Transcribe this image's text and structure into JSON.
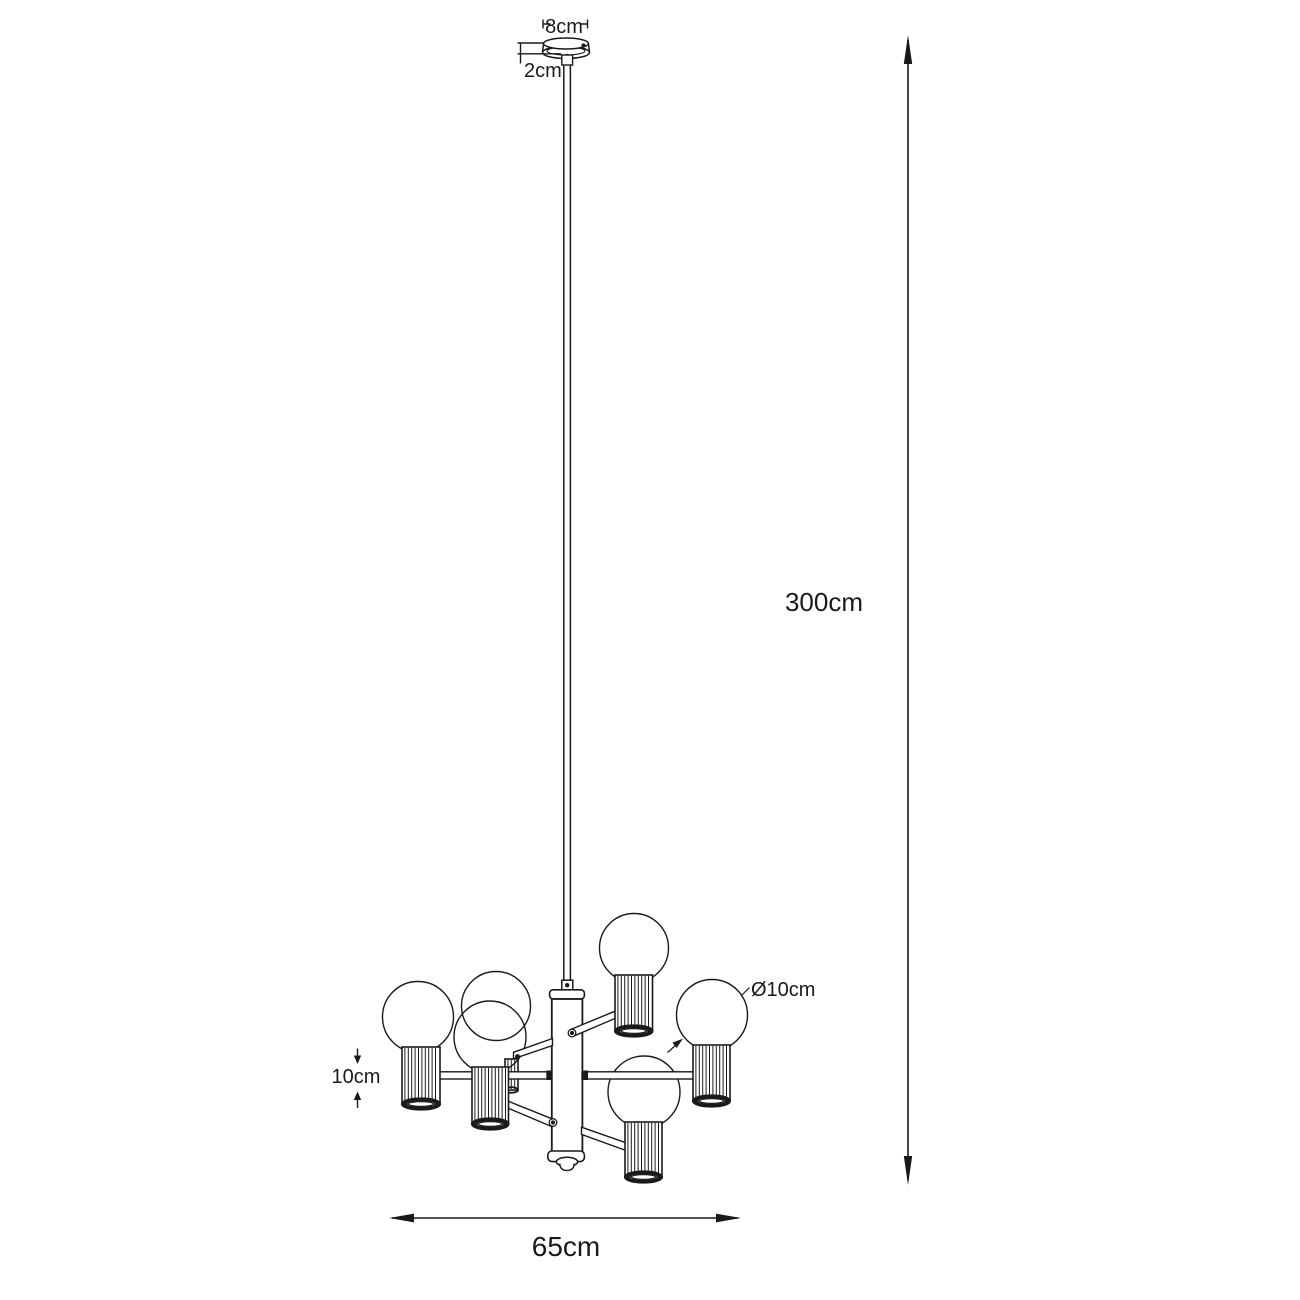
{
  "drawing": {
    "labels": {
      "canopy_diameter": "8cm",
      "canopy_height": "2cm",
      "suspension_height": "300cm",
      "fixture_width": "65cm",
      "shade_height": "10cm",
      "bulb_diameter": "Ø10cm"
    },
    "colors": {
      "line": "#1a1a1a",
      "background": "#ffffff"
    }
  }
}
